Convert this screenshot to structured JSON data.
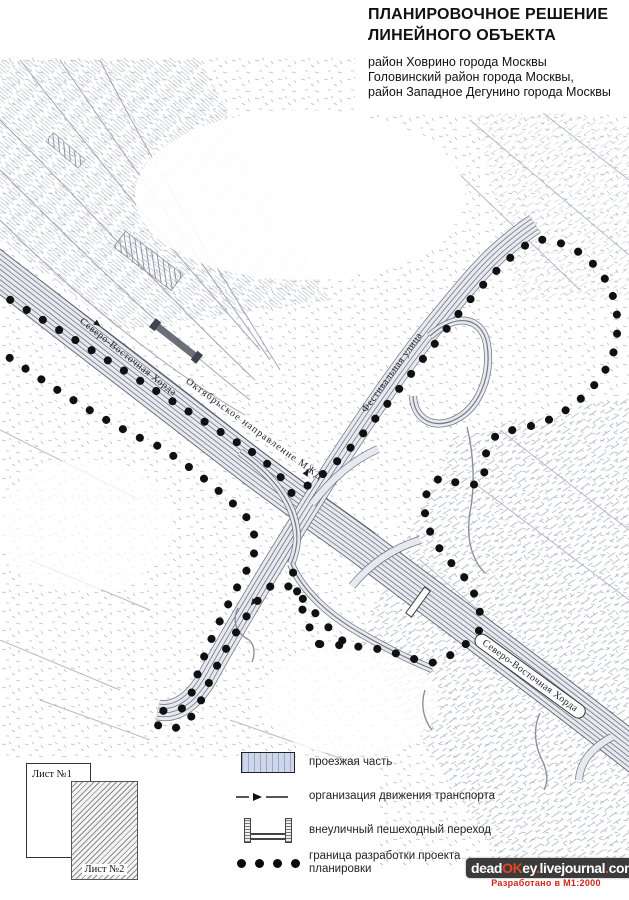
{
  "title": {
    "line1": "ПЛАНИРОВОЧНОЕ РЕШЕНИЕ",
    "line2": "ЛИНЕЙНОГО ОБЪЕКТА",
    "districts": [
      "район  Ховрино города Москвы",
      "Головинский район города Москвы,",
      "район Западное Дегунино города Москвы"
    ]
  },
  "map": {
    "labels": {
      "chord_nw": "Северо-Восточная Хорда",
      "railway": "Октябрьское направление МЖД",
      "festival_street": "Фестивальная улица",
      "chord_se": "Северо-Восточная Хорда"
    }
  },
  "legend": {
    "items": [
      {
        "symbol": "roadway-swatch",
        "label": "проезжая часть"
      },
      {
        "symbol": "traffic-arrow",
        "label": "организация движения транспорта"
      },
      {
        "symbol": "pedestrian-bridge",
        "label": "внеуличный пешеходный переход"
      },
      {
        "symbol": "boundary-dots",
        "label": "граница разработки проекта планировки"
      }
    ]
  },
  "inset": {
    "sheet1_label": "Лист №1",
    "sheet2_label": "Лист №2"
  },
  "watermark": {
    "segments": [
      {
        "text": "dead"
      },
      {
        "text": "OK"
      },
      {
        "text": "ey"
      },
      {
        "text": "."
      },
      {
        "text": "livejournal"
      },
      {
        "text": "."
      },
      {
        "text": "com"
      }
    ],
    "note": "Разработано в М1:2000"
  },
  "colors": {
    "boundary_dot": "#111111",
    "road_line": "#4f545e",
    "road_fill": "#e6e9f0",
    "watermark_bg": "#3b3b3b",
    "watermark_red": "#e8471f"
  }
}
